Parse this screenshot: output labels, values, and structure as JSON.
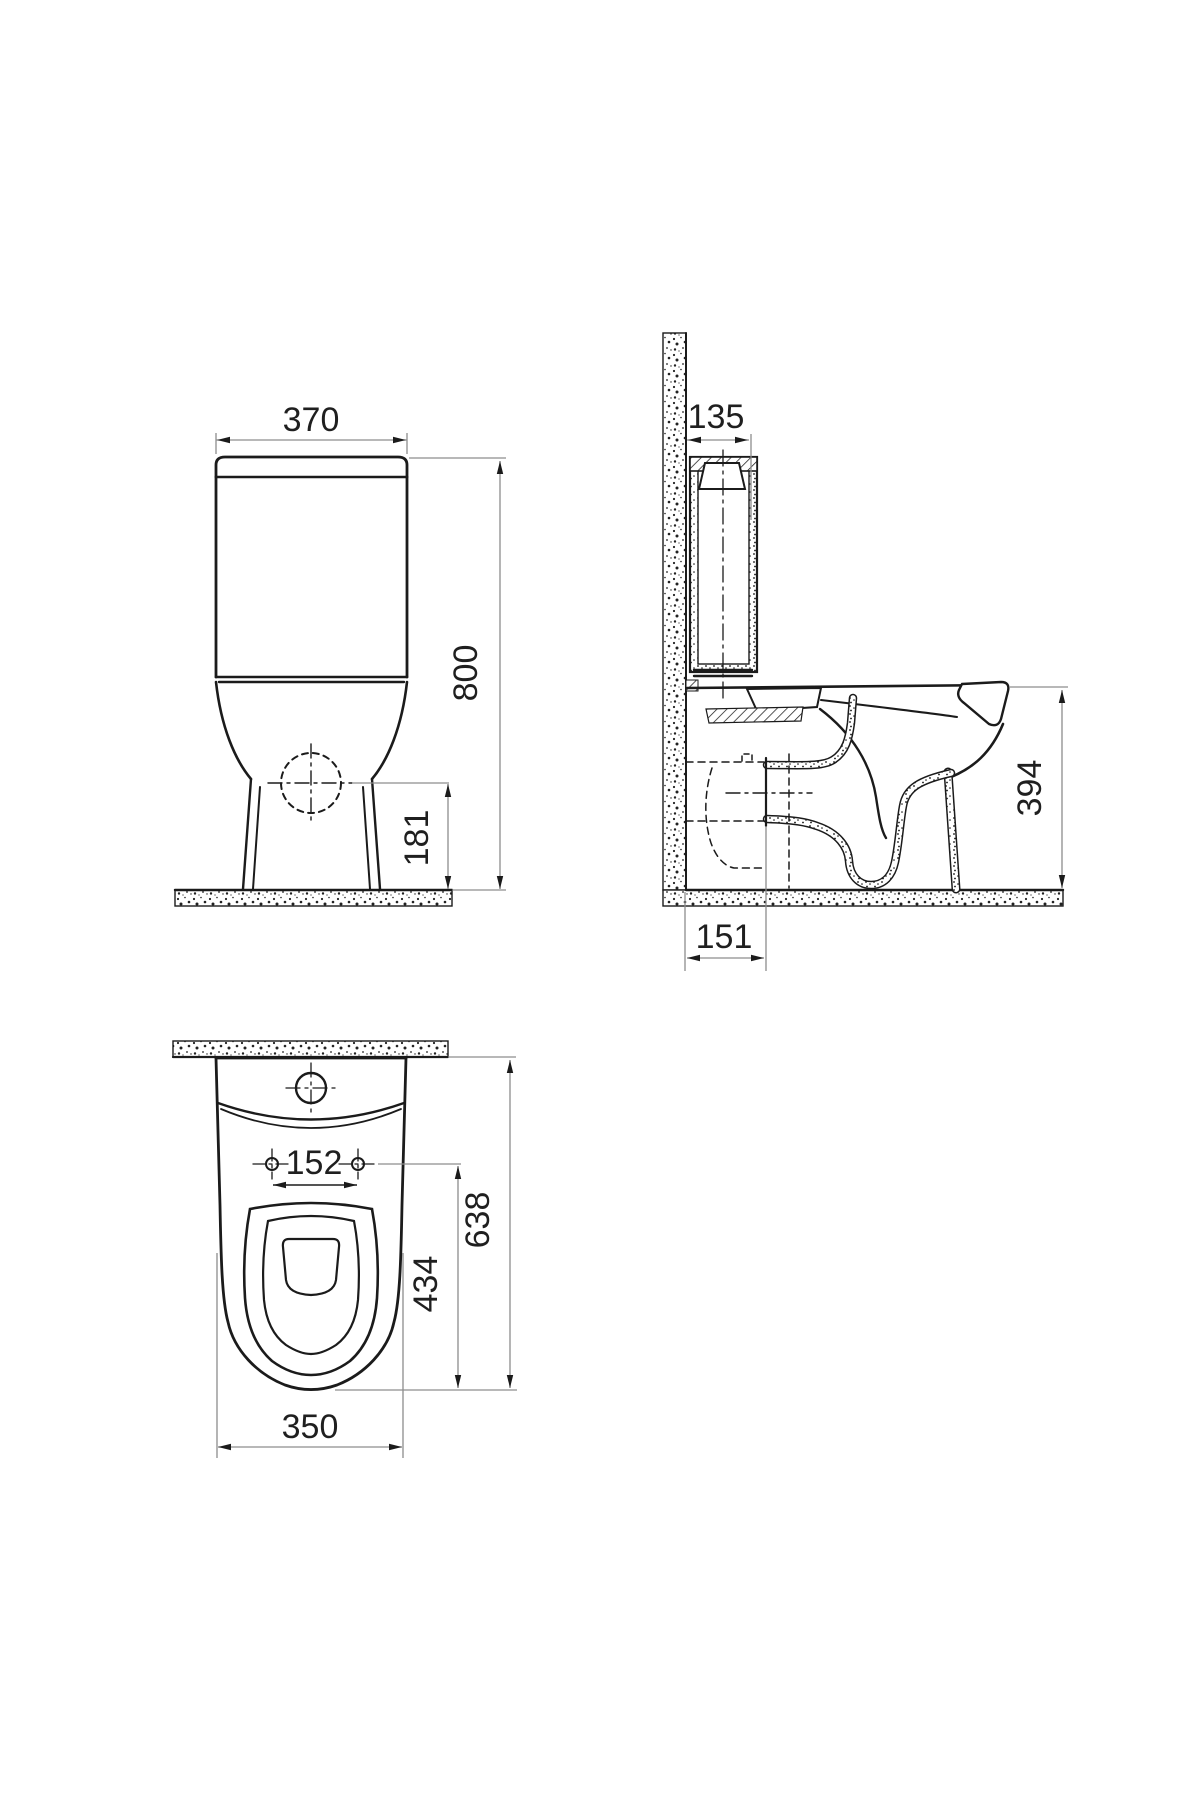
{
  "document": {
    "type": "technical-drawing",
    "subject": "close-coupled toilet (WC) dimensional drawing",
    "views": [
      "front",
      "side-section",
      "plan"
    ]
  },
  "dims": {
    "front_width": "370",
    "front_total_height": "800",
    "front_inlet_height": "181",
    "side_cistern_depth": "135",
    "side_rim_height": "394",
    "side_outlet_offset": "151",
    "plan_hinge_centers": "152",
    "plan_seat_cutout_depth": "434",
    "plan_total_depth": "638",
    "plan_bowl_width": "350"
  },
  "colors": {
    "background": "#ffffff",
    "object_line": "#1b1b1b",
    "dimension_line": "#8d8d8d",
    "text": "#1f1f1f"
  }
}
